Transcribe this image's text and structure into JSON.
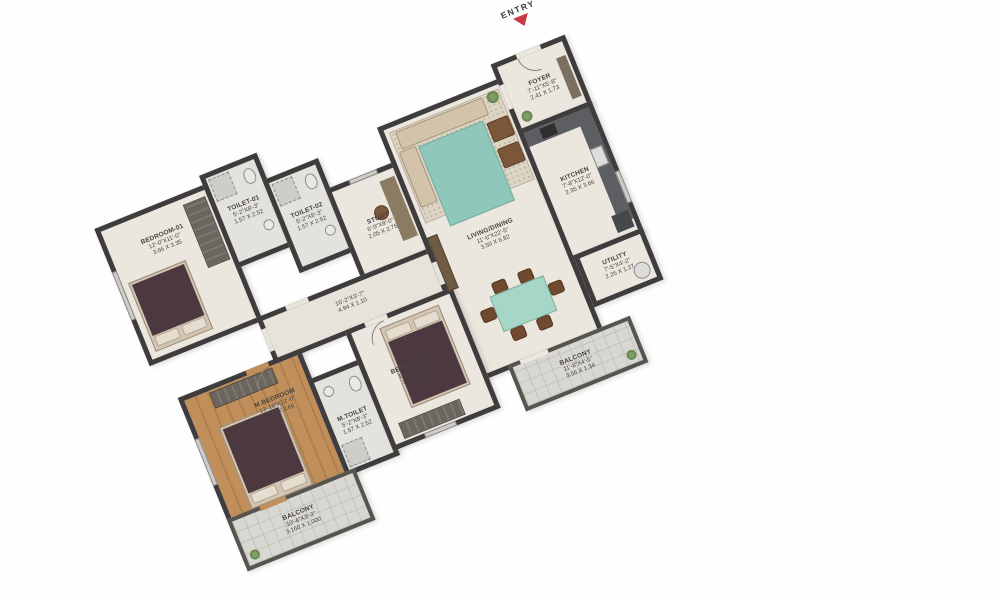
{
  "entry_label": "ENTRY",
  "rooms": {
    "foyer": {
      "name": "FOYER",
      "ft": "7'-11\"X5'-8\"",
      "m": "2.41 X 1.73"
    },
    "living": {
      "name": "LIVING/DINING",
      "ft": "11'-6\"X22'-5\"",
      "m": "3.50 X 6.82"
    },
    "kitchen": {
      "name": "KITCHEN",
      "ft": "7'-8\"X12'-0\"",
      "m": "2.35 X 3.66"
    },
    "utility": {
      "name": "UTILITY",
      "ft": "7'-5\"X4'-2\"",
      "m": "2.26 X 1.27"
    },
    "bedroom1": {
      "name": "BEDROOM-01",
      "ft": "12'-0\"X11'-0\"",
      "m": "3.66 X 3.35"
    },
    "toilet1": {
      "name": "TOILET-01",
      "ft": "5'-2\"X8'-3\"",
      "m": "1.57 X 2.52"
    },
    "toilet2": {
      "name": "TOILET-02",
      "ft": "5'-2\"X8'-3\"",
      "m": "1.57 X 2.52"
    },
    "study": {
      "name": "STUDY",
      "ft": "6'-9\"X9'-0\"",
      "m": "2.05 X 2.75"
    },
    "corridor": {
      "name": "",
      "ft": "16'-2\"X3'-7\"",
      "m": "4.94 X 1.10"
    },
    "mbedroom": {
      "name": "M.BEDROOM",
      "ft": "13'-10\"X12'-0\"",
      "m": "4.23 X 3.66"
    },
    "mtoilet": {
      "name": "M.TOILET",
      "ft": "5'-2\"X8'-3\"",
      "m": "1.57 X 2.52"
    },
    "bedroom2": {
      "name": "BEDROOM-02",
      "ft": "10'-6\"X12'-0\"",
      "m": "3.21 X 3.66"
    },
    "balconyRight": {
      "name": "BALCONY",
      "ft": "11'-8\"X4'-5\"",
      "m": "3.56 X 1.34"
    },
    "balconyBottom": {
      "name": "BALCONY",
      "ft": "10'-4\"X3'-3\"",
      "m": "3.160 X 1.000"
    }
  },
  "colors": {
    "wall": "#3e3c3d",
    "floor": "#ebe7df",
    "wood_floor": "#b8854f",
    "teal_accent": "#8fc8ba",
    "bed_fabric": "#4c393f",
    "entry_arrow": "#cb3a44",
    "balcony_floor": "#d9d7d2"
  }
}
